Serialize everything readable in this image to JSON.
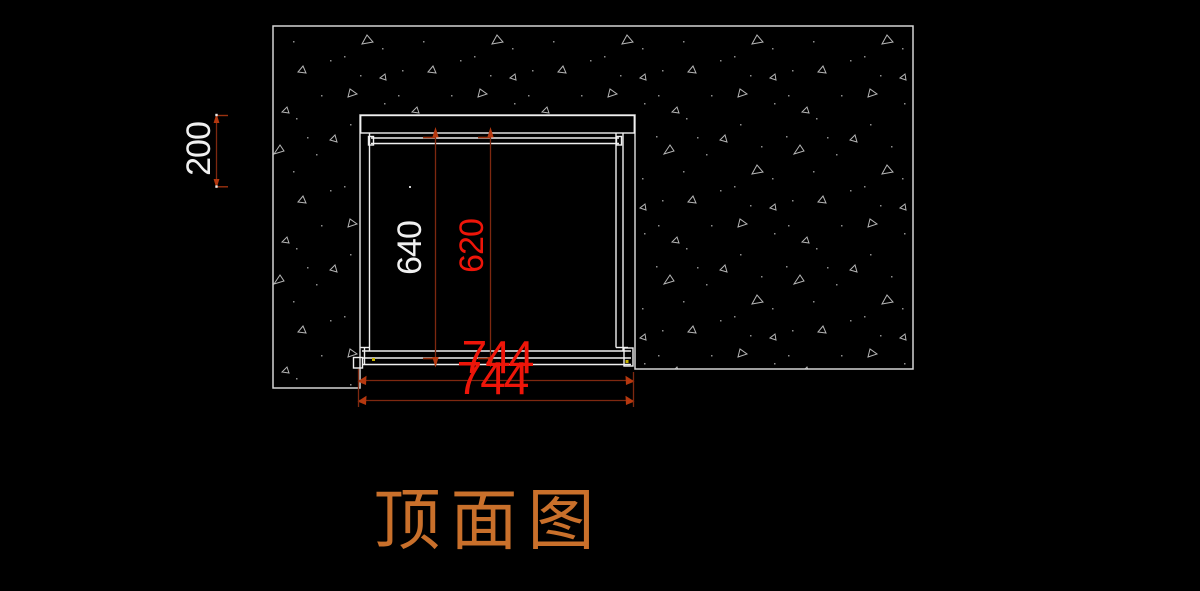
{
  "drawing_title": {
    "text": "顶面图",
    "color": "#c9702b"
  },
  "dimensions": {
    "d200": {
      "value": "200",
      "color": "#f0f0f0",
      "orientation": "vertical"
    },
    "d640": {
      "value": "640",
      "color": "#f0f0f0",
      "orientation": "vertical"
    },
    "d620": {
      "value": "620",
      "color": "#ee1509",
      "orientation": "vertical"
    },
    "d744_upper": {
      "value": "744",
      "color": "#ee1509",
      "orientation": "horizontal"
    },
    "d744_lower": {
      "value": "744",
      "color": "#ee1509",
      "orientation": "horizontal"
    }
  },
  "colors": {
    "background": "#000000",
    "cabinet_linework": "#f0f0f0",
    "hatch_border": "#d4d4d4",
    "hatch_speckle": "#b4b4b4",
    "dimension_line": "#7e2810",
    "dimension_arrow": "#b5380f",
    "point_marker": "#c8b400"
  }
}
